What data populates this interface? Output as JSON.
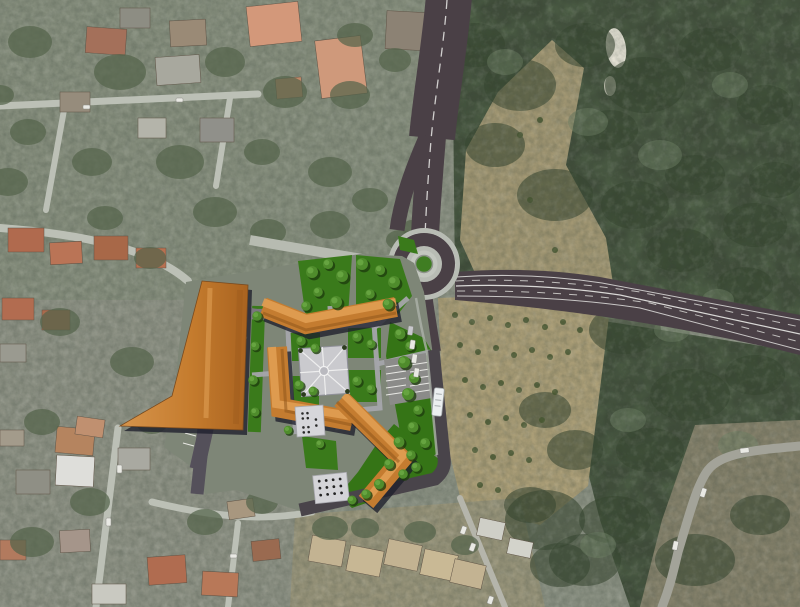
{
  "meta": {
    "title": "Aerial masterplan visualization",
    "description": "Satellite photograph with a rendered masterplan overlay: a new roundabout junction beside woodland, and a residential block development with orange tiled roofs, a central paved plaza, courtyard lawns, tree planting, parking bays and access roads.",
    "canvas": {
      "width": 800,
      "height": 607
    }
  },
  "scene": {
    "satellite": {
      "urban_area": "existing town fabric with red and tan roofed houses, gardens and narrow streets (left and bottom)",
      "forest": "dense dark tree canopy (right half)",
      "olive_grove": "pale scrubland with scattered small trees (center right)",
      "winding_road": "existing light asphalt road with hairpin bend (bottom right)",
      "clearing": "small bright clearing in the woodland (top right)"
    },
    "overlay": {
      "roundabout": {
        "label": "new roundabout",
        "center_island": "green planted island",
        "legs": [
          "north approach road",
          "east dual-carriageway",
          "south access road",
          "west local street"
        ]
      },
      "roads": {
        "surface": "dark asphalt",
        "markings": [
          "white centre dashes",
          "white edge lines",
          "pedestrian crossing"
        ]
      },
      "masterplan": {
        "buildings": [
          "long slab block (west)",
          "bent courtyard block (north)",
          "L-shaped courtyard block (southwest)",
          "bent block (southeast)"
        ],
        "roof_color": "terracotta orange",
        "plaza": "square piazza with radial paving and central circle",
        "courtyards": "lawns with ornamental trees",
        "parking": [
          "angled bays along west access road",
          "surface parking lot on east side"
        ],
        "street_furniture": [
          "zebra crossing",
          "bus on south access road",
          "parked cars",
          "two patio decks with tables"
        ]
      }
    }
  },
  "palette": {
    "overlay_road": "#4a4046",
    "road_marking": "#e9e9e6",
    "roundabout_apron": "#b8bcb4",
    "island_green": "#3f7d22",
    "plan_lawn": "#3a7a1b",
    "tree_canopy": "#4f8c2c",
    "building_orange": "#c47c30",
    "building_highlight": "#df9d52",
    "building_shadow": "#1d1f2b",
    "plaza_paving": "#cacace",
    "internal_road": "#55505b",
    "forest": "#3f4c39",
    "olive_scrub": "#ab9e77",
    "urban_base": "#8a9082",
    "house_roof_red": "#b06a4e",
    "house_roof_salmon": "#d3987a",
    "existing_street": "#bcc0b6"
  }
}
